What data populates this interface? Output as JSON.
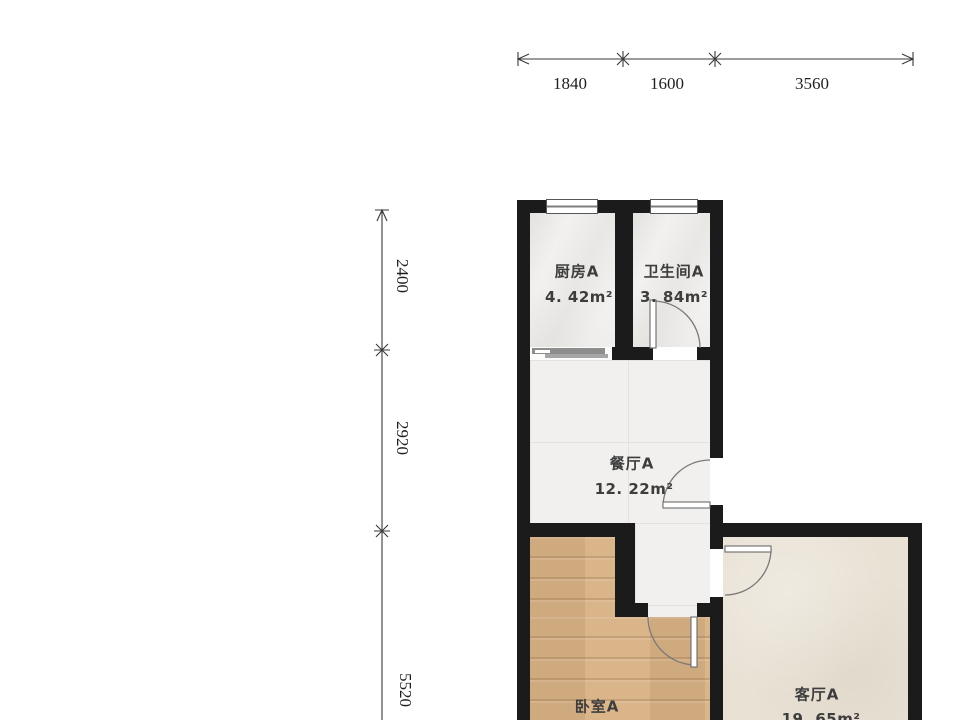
{
  "dims": {
    "top": [
      "1840",
      "1600",
      "3560"
    ],
    "left": [
      "2400",
      "2920",
      "5520"
    ]
  },
  "rooms": {
    "kitchen": {
      "name": "厨房A",
      "area": "4. 42m²"
    },
    "bathroom": {
      "name": "卫生间A",
      "area": "3. 84m²"
    },
    "dining": {
      "name": "餐厅A",
      "area": "12. 22m²"
    },
    "bedroom": {
      "name": "卧室A"
    },
    "living": {
      "name": "客厅A",
      "area": "19. 65m²"
    }
  },
  "colors": {
    "wall": "#1b1b1b",
    "floor_marble": "#f2f1ef",
    "floor_tile": "#f1f0ee",
    "floor_wood": "#d9b184",
    "floor_living": "#e8e1d4",
    "dimension_line": "#3a3a3a",
    "door_line": "#7a7a7a"
  }
}
